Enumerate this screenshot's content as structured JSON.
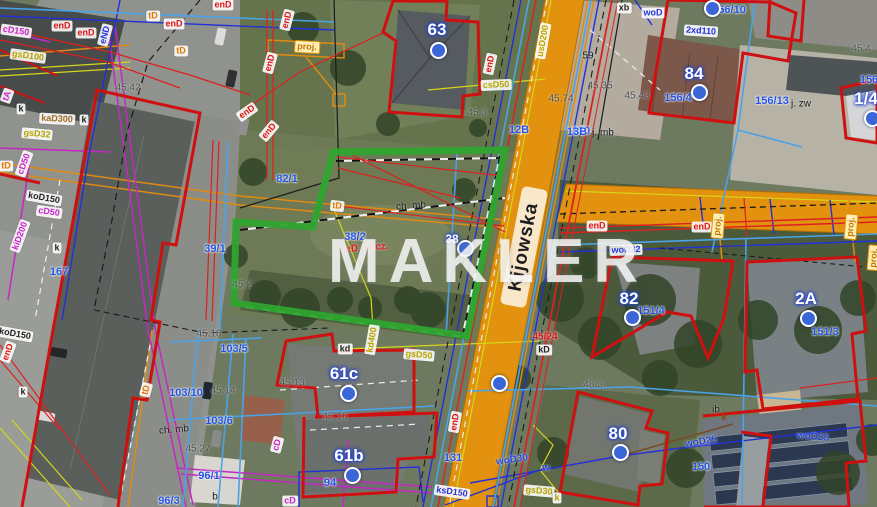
{
  "watermark": "MAKLER",
  "street": {
    "name": "Kijowska"
  },
  "colors": {
    "road": "#e2920e",
    "parcel_highlight": "#2fa52f",
    "building_outline": "#cf1010",
    "address_marker": "#3a66d8"
  },
  "markers": [
    {
      "n": "63",
      "x": 437,
      "y": 30,
      "dx": 436,
      "dy": 48
    },
    {
      "n": "84",
      "x": 694,
      "y": 74,
      "dx": 697,
      "dy": 90
    },
    {
      "n": "82",
      "x": 629,
      "y": 299,
      "dx": 630,
      "dy": 315
    },
    {
      "n": "2A",
      "x": 806,
      "y": 299,
      "dx": 806,
      "dy": 316
    },
    {
      "n": "80",
      "x": 618,
      "y": 434,
      "dx": 618,
      "dy": 450
    },
    {
      "n": "61c",
      "x": 344,
      "y": 374,
      "dx": 346,
      "dy": 391
    },
    {
      "n": "61b",
      "x": 349,
      "y": 456,
      "dx": 350,
      "dy": 473
    },
    {
      "n": "1/4",
      "x": 866,
      "y": 99,
      "dx": 870,
      "dy": 116
    },
    {
      "n": "38",
      "x": 452,
      "y": 239,
      "dx": 463,
      "dy": 246,
      "small": true
    }
  ],
  "dots": [
    {
      "x": 710,
      "y": 6
    },
    {
      "x": 497,
      "y": 381
    }
  ],
  "labels": [
    {
      "t": "156/10",
      "x": 729,
      "y": 10,
      "c": "parcel"
    },
    {
      "t": "156/4",
      "x": 678,
      "y": 98,
      "c": "parcel"
    },
    {
      "t": "156/13",
      "x": 772,
      "y": 101,
      "c": "parcel"
    },
    {
      "t": "j. zw",
      "x": 801,
      "y": 104,
      "c": "blk"
    },
    {
      "t": "151/4",
      "x": 651,
      "y": 311,
      "c": "parcel"
    },
    {
      "t": "151/3",
      "x": 825,
      "y": 332,
      "c": "parcel"
    },
    {
      "t": "167",
      "x": 59,
      "y": 272,
      "c": "parcel"
    },
    {
      "t": "39/1",
      "x": 215,
      "y": 249,
      "c": "parcel"
    },
    {
      "t": "82/1",
      "x": 287,
      "y": 179,
      "c": "parcel"
    },
    {
      "t": "38/2",
      "x": 355,
      "y": 237,
      "c": "parcel"
    },
    {
      "t": "103/5",
      "x": 234,
      "y": 349,
      "c": "parcel"
    },
    {
      "t": "103/10",
      "x": 186,
      "y": 393,
      "c": "parcel"
    },
    {
      "t": "103/6",
      "x": 219,
      "y": 421,
      "c": "parcel"
    },
    {
      "t": "96/1",
      "x": 209,
      "y": 476,
      "c": "parcel"
    },
    {
      "t": "96/3",
      "x": 169,
      "y": 501,
      "c": "parcel"
    },
    {
      "t": "94",
      "x": 330,
      "y": 483,
      "c": "parcel"
    },
    {
      "t": "150",
      "x": 701,
      "y": 467,
      "c": "parcel"
    },
    {
      "t": "131",
      "x": 453,
      "y": 458,
      "c": "parcel"
    },
    {
      "t": "130",
      "x": 581,
      "y": 131,
      "c": "parcel"
    },
    {
      "t": "j. mb",
      "x": 603,
      "y": 133,
      "c": "blk"
    },
    {
      "t": "12B",
      "x": 519,
      "y": 130,
      "c": "parcel"
    },
    {
      "t": "13B",
      "x": 577,
      "y": 132,
      "c": "parcel"
    },
    {
      "t": "156",
      "x": 869,
      "y": 80,
      "c": "parcel"
    },
    {
      "t": "45.42",
      "x": 128,
      "y": 88,
      "c": "elev"
    },
    {
      "t": "45.3",
      "x": 477,
      "y": 113,
      "c": "elev"
    },
    {
      "t": "45.4",
      "x": 861,
      "y": 49,
      "c": "elev"
    },
    {
      "t": "45.43",
      "x": 637,
      "y": 96,
      "c": "elev"
    },
    {
      "t": "45.35",
      "x": 600,
      "y": 86,
      "c": "elev"
    },
    {
      "t": "59",
      "x": 588,
      "y": 56,
      "c": "blk"
    },
    {
      "t": "45.74",
      "x": 561,
      "y": 99,
      "c": "elev"
    },
    {
      "t": "45.13",
      "x": 292,
      "y": 383,
      "c": "elev"
    },
    {
      "t": "45.14",
      "x": 223,
      "y": 391,
      "c": "elev"
    },
    {
      "t": "45.16",
      "x": 335,
      "y": 417,
      "c": "elev"
    },
    {
      "t": "45.18",
      "x": 209,
      "y": 334,
      "c": "elev"
    },
    {
      "t": "45.2",
      "x": 242,
      "y": 285,
      "c": "elev"
    },
    {
      "t": "48.3",
      "x": 593,
      "y": 385,
      "c": "elev"
    },
    {
      "t": "45.27",
      "x": 198,
      "y": 449,
      "c": "elev"
    },
    {
      "t": "ch. mb",
      "x": 411,
      "y": 206,
      "c": "blk",
      "r": -4
    },
    {
      "t": "ch. mb",
      "x": 174,
      "y": 430,
      "c": "blk",
      "r": -5
    },
    {
      "t": "45/24",
      "x": 545,
      "y": 337,
      "c": "redp"
    },
    {
      "t": "kD",
      "x": 544,
      "y": 350,
      "c": "bx bxw"
    },
    {
      "t": "eD niecz.",
      "x": 367,
      "y": 248,
      "c": "redp",
      "r": -4
    },
    {
      "t": "enD",
      "x": 62,
      "y": 26,
      "c": "bx bxr"
    },
    {
      "t": "enD",
      "x": 86,
      "y": 33,
      "c": "bx bxr"
    },
    {
      "t": "enD",
      "x": 174,
      "y": 24,
      "c": "bx bxr"
    },
    {
      "t": "enD",
      "x": 223,
      "y": 5,
      "c": "bx bxr"
    },
    {
      "t": "enD",
      "x": 287,
      "y": 20,
      "c": "bx bxr",
      "r": -75
    },
    {
      "t": "enD",
      "x": 270,
      "y": 63,
      "c": "bx bxr",
      "r": -75
    },
    {
      "t": "enD",
      "x": 247,
      "y": 112,
      "c": "bx bxr",
      "r": -35
    },
    {
      "t": "enD",
      "x": 269,
      "y": 131,
      "c": "bx bxr",
      "r": -50
    },
    {
      "t": "enD",
      "x": 490,
      "y": 64,
      "c": "bx bxr",
      "r": -78
    },
    {
      "t": "enD",
      "x": 597,
      "y": 226,
      "c": "bx bxr"
    },
    {
      "t": "enD",
      "x": 702,
      "y": 227,
      "c": "bx bxr"
    },
    {
      "t": "enD",
      "x": 455,
      "y": 422,
      "c": "bx bxr",
      "r": -80
    },
    {
      "t": "enD",
      "x": 8,
      "y": 352,
      "c": "bx bxr",
      "r": -70
    },
    {
      "t": "eND",
      "x": 105,
      "y": 35,
      "c": "bx bxb",
      "r": -75
    },
    {
      "t": "woD",
      "x": 653,
      "y": 13,
      "c": "bx bxb"
    },
    {
      "t": "2xd110",
      "x": 701,
      "y": 31,
      "c": "bx bxb",
      "r": 4
    },
    {
      "t": "woD32",
      "x": 626,
      "y": 250,
      "c": "bx bxb",
      "r": -2
    },
    {
      "t": "ksD150",
      "x": 452,
      "y": 492,
      "c": "bx bxb",
      "r": 8
    },
    {
      "t": "xb",
      "x": 624,
      "y": 8,
      "c": "bx bxw"
    },
    {
      "t": "woD30",
      "x": 512,
      "y": 460,
      "c": "bluep",
      "r": -8
    },
    {
      "t": "w",
      "x": 546,
      "y": 468,
      "c": "bluep"
    },
    {
      "t": "woD25",
      "x": 701,
      "y": 442,
      "c": "bluep",
      "r": -9
    },
    {
      "t": "woD25",
      "x": 813,
      "y": 437,
      "c": "bluep",
      "r": 5
    },
    {
      "t": "gsD100",
      "x": 28,
      "y": 56,
      "c": "bx bxy",
      "r": 8
    },
    {
      "t": "gsD32",
      "x": 37,
      "y": 134,
      "c": "bx bxy",
      "r": 5
    },
    {
      "t": "csD50",
      "x": 496,
      "y": 85,
      "c": "bx bxy",
      "r": -2
    },
    {
      "t": "usD200",
      "x": 543,
      "y": 41,
      "c": "bx bxy",
      "r": -80
    },
    {
      "t": "gsD50",
      "x": 419,
      "y": 355,
      "c": "bx bxy",
      "r": 5
    },
    {
      "t": "gsD30",
      "x": 539,
      "y": 491,
      "c": "bx bxy",
      "r": 5
    },
    {
      "t": "kd400",
      "x": 372,
      "y": 340,
      "c": "bx bxy",
      "r": -80
    },
    {
      "t": "k",
      "x": 557,
      "y": 498,
      "c": "bx bxy"
    },
    {
      "t": "cD150",
      "x": 16,
      "y": 31,
      "c": "bx bxm",
      "r": 8
    },
    {
      "t": "cD50",
      "x": 24,
      "y": 164,
      "c": "bx bxm",
      "r": -70
    },
    {
      "t": "cD50",
      "x": 49,
      "y": 212,
      "c": "bx bxm",
      "r": 8
    },
    {
      "t": "kiD200",
      "x": 20,
      "y": 236,
      "c": "bx bxm",
      "r": -70
    },
    {
      "t": "tA",
      "x": 7,
      "y": 96,
      "c": "bx bxm",
      "r": -70
    },
    {
      "t": "cD",
      "x": 277,
      "y": 445,
      "c": "bx bxm",
      "r": -75
    },
    {
      "t": "cD",
      "x": 290,
      "y": 501,
      "c": "bx bxm"
    },
    {
      "t": "tD",
      "x": 153,
      "y": 16,
      "c": "bx bxo"
    },
    {
      "t": "tD",
      "x": 181,
      "y": 51,
      "c": "bx bxo"
    },
    {
      "t": "tD",
      "x": 6,
      "y": 166,
      "c": "bx bxo"
    },
    {
      "t": "tD",
      "x": 337,
      "y": 206,
      "c": "bx bxo",
      "r": 6
    },
    {
      "t": "tD",
      "x": 146,
      "y": 390,
      "c": "bx bxo",
      "r": -75
    },
    {
      "t": "proj.",
      "x": 307,
      "y": 47,
      "c": "proj",
      "r": 3
    },
    {
      "t": "proj.",
      "x": 718,
      "y": 226,
      "c": "proj",
      "r": -85
    },
    {
      "t": "proj.",
      "x": 851,
      "y": 227,
      "c": "proj",
      "r": -85
    },
    {
      "t": "proj.",
      "x": 874,
      "y": 258,
      "c": "proj",
      "r": -85
    },
    {
      "t": "k",
      "x": 21,
      "y": 109,
      "c": "bx bxw"
    },
    {
      "t": "k",
      "x": 84,
      "y": 120,
      "c": "bx bxw"
    },
    {
      "t": "k",
      "x": 57,
      "y": 248,
      "c": "bx bxw"
    },
    {
      "t": "k",
      "x": 23,
      "y": 392,
      "c": "bx bxw"
    },
    {
      "t": "koD150",
      "x": 44,
      "y": 198,
      "c": "bx bxw",
      "r": 10
    },
    {
      "t": "koD150",
      "x": 15,
      "y": 334,
      "c": "bx bxw",
      "r": 10
    },
    {
      "t": "kaD300",
      "x": 57,
      "y": 119,
      "c": "bx bxt",
      "r": 3
    },
    {
      "t": "kd",
      "x": 345,
      "y": 349,
      "c": "bx bxw"
    },
    {
      "t": "b",
      "x": 215,
      "y": 497,
      "c": "blk"
    },
    {
      "t": "ib",
      "x": 716,
      "y": 410,
      "c": "blk"
    },
    {
      "t": "k",
      "x": 724,
      "y": 418,
      "c": "brn"
    }
  ]
}
